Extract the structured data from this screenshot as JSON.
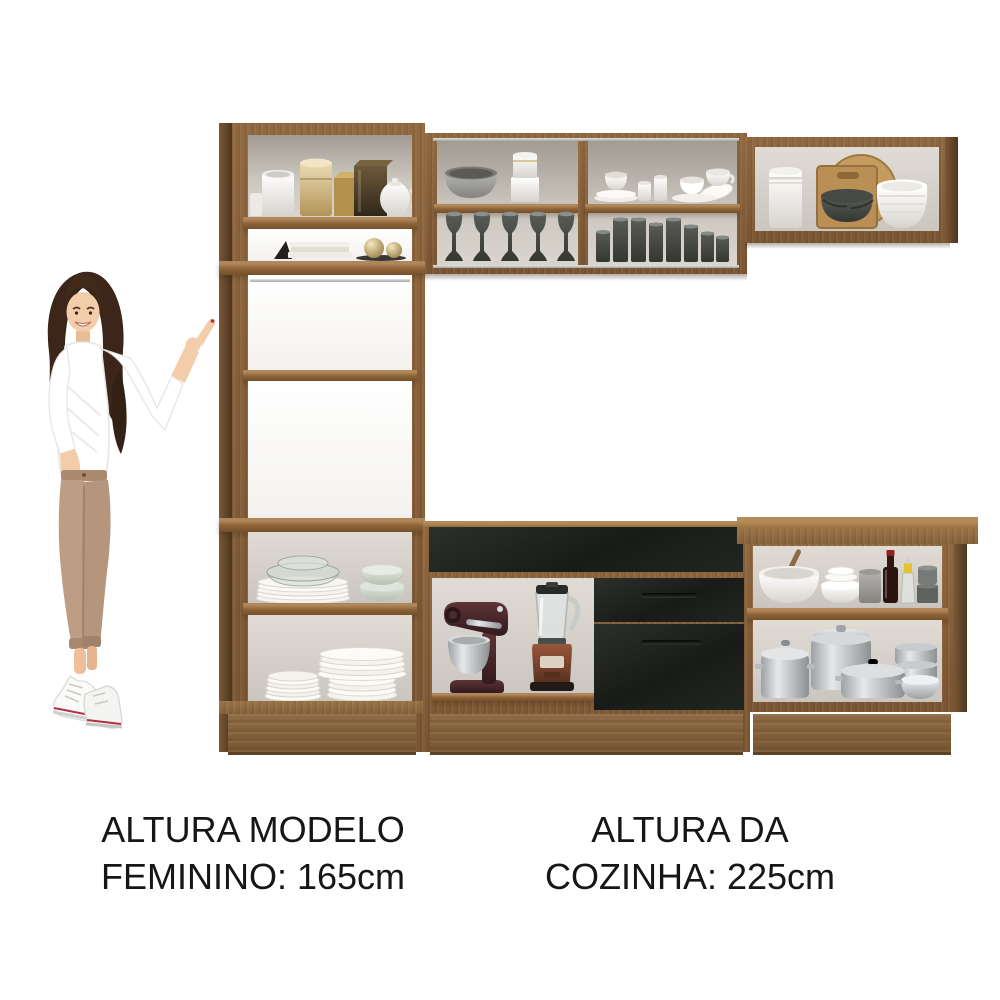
{
  "captions": {
    "model_height": {
      "line1": "ALTURA MODELO",
      "line2": "FEMININO: 165cm"
    },
    "kitchen_height": {
      "line1": "ALTURA DA",
      "line2": "COZINHA: 225cm"
    }
  },
  "scene": {
    "description": "Product comparison image: woman (165cm) pointing at a complete kitchen cabinet set (225cm tall) in rustic brown wood with black drawer fronts, shelves filled with dishware, glasses, appliances and cookware.",
    "model": {
      "pose": "standing, legs crossed, left hand in pocket, right hand raised pointing up toward the kitchen",
      "hair_color": "#3b2619",
      "top_color": "#ffffff",
      "pants_color": "#bd9e84",
      "shoes_color": "#ffffff",
      "skin_color": "#f3cda9"
    },
    "kitchen_set": {
      "finish": {
        "wood": "#8f683f",
        "black_fronts": "#1d201c",
        "interior": "#d6d2cb",
        "aluminum_trim": "#c9c9c7"
      },
      "units": [
        {
          "name": "tall-cabinet-left",
          "contents": [
            "white mug",
            "cream canister",
            "gold box",
            "bronze box",
            "white teapot",
            "stack of books",
            "two gold decor spheres",
            "glass bowls on white plate stack",
            "celadon scalloped bowls",
            "small white plate stack",
            "large white plate stack"
          ]
        },
        {
          "name": "wall-cabinet-center",
          "contents": [
            "grey bowl",
            "white canister stack",
            "five smoked-glass stemmed glasses",
            "white espresso cups and saucers",
            "white teacup set",
            "smoked-glass tumblers"
          ]
        },
        {
          "name": "wall-cabinet-right",
          "contents": [
            "white ridged jar",
            "round wooden cutting board",
            "square board with dark grey bowls",
            "white bowl stack"
          ]
        },
        {
          "name": "base-cabinet-center",
          "contents": [
            "full-width black drawer",
            "stand mixer with steel bowl",
            "blender with copper base",
            "two black drawers with bar handles"
          ]
        },
        {
          "name": "base-cabinet-right",
          "contents": [
            "white mixing bowl with wooden pestle",
            "white bowl stack",
            "grey canister",
            "dark sauce bottle",
            "oil bottle with yellow cap",
            "grey container stack",
            "steel stockpot",
            "steel pot with lid",
            "steel casserole",
            "stacked steel steamers",
            "steel pan"
          ]
        }
      ]
    }
  }
}
